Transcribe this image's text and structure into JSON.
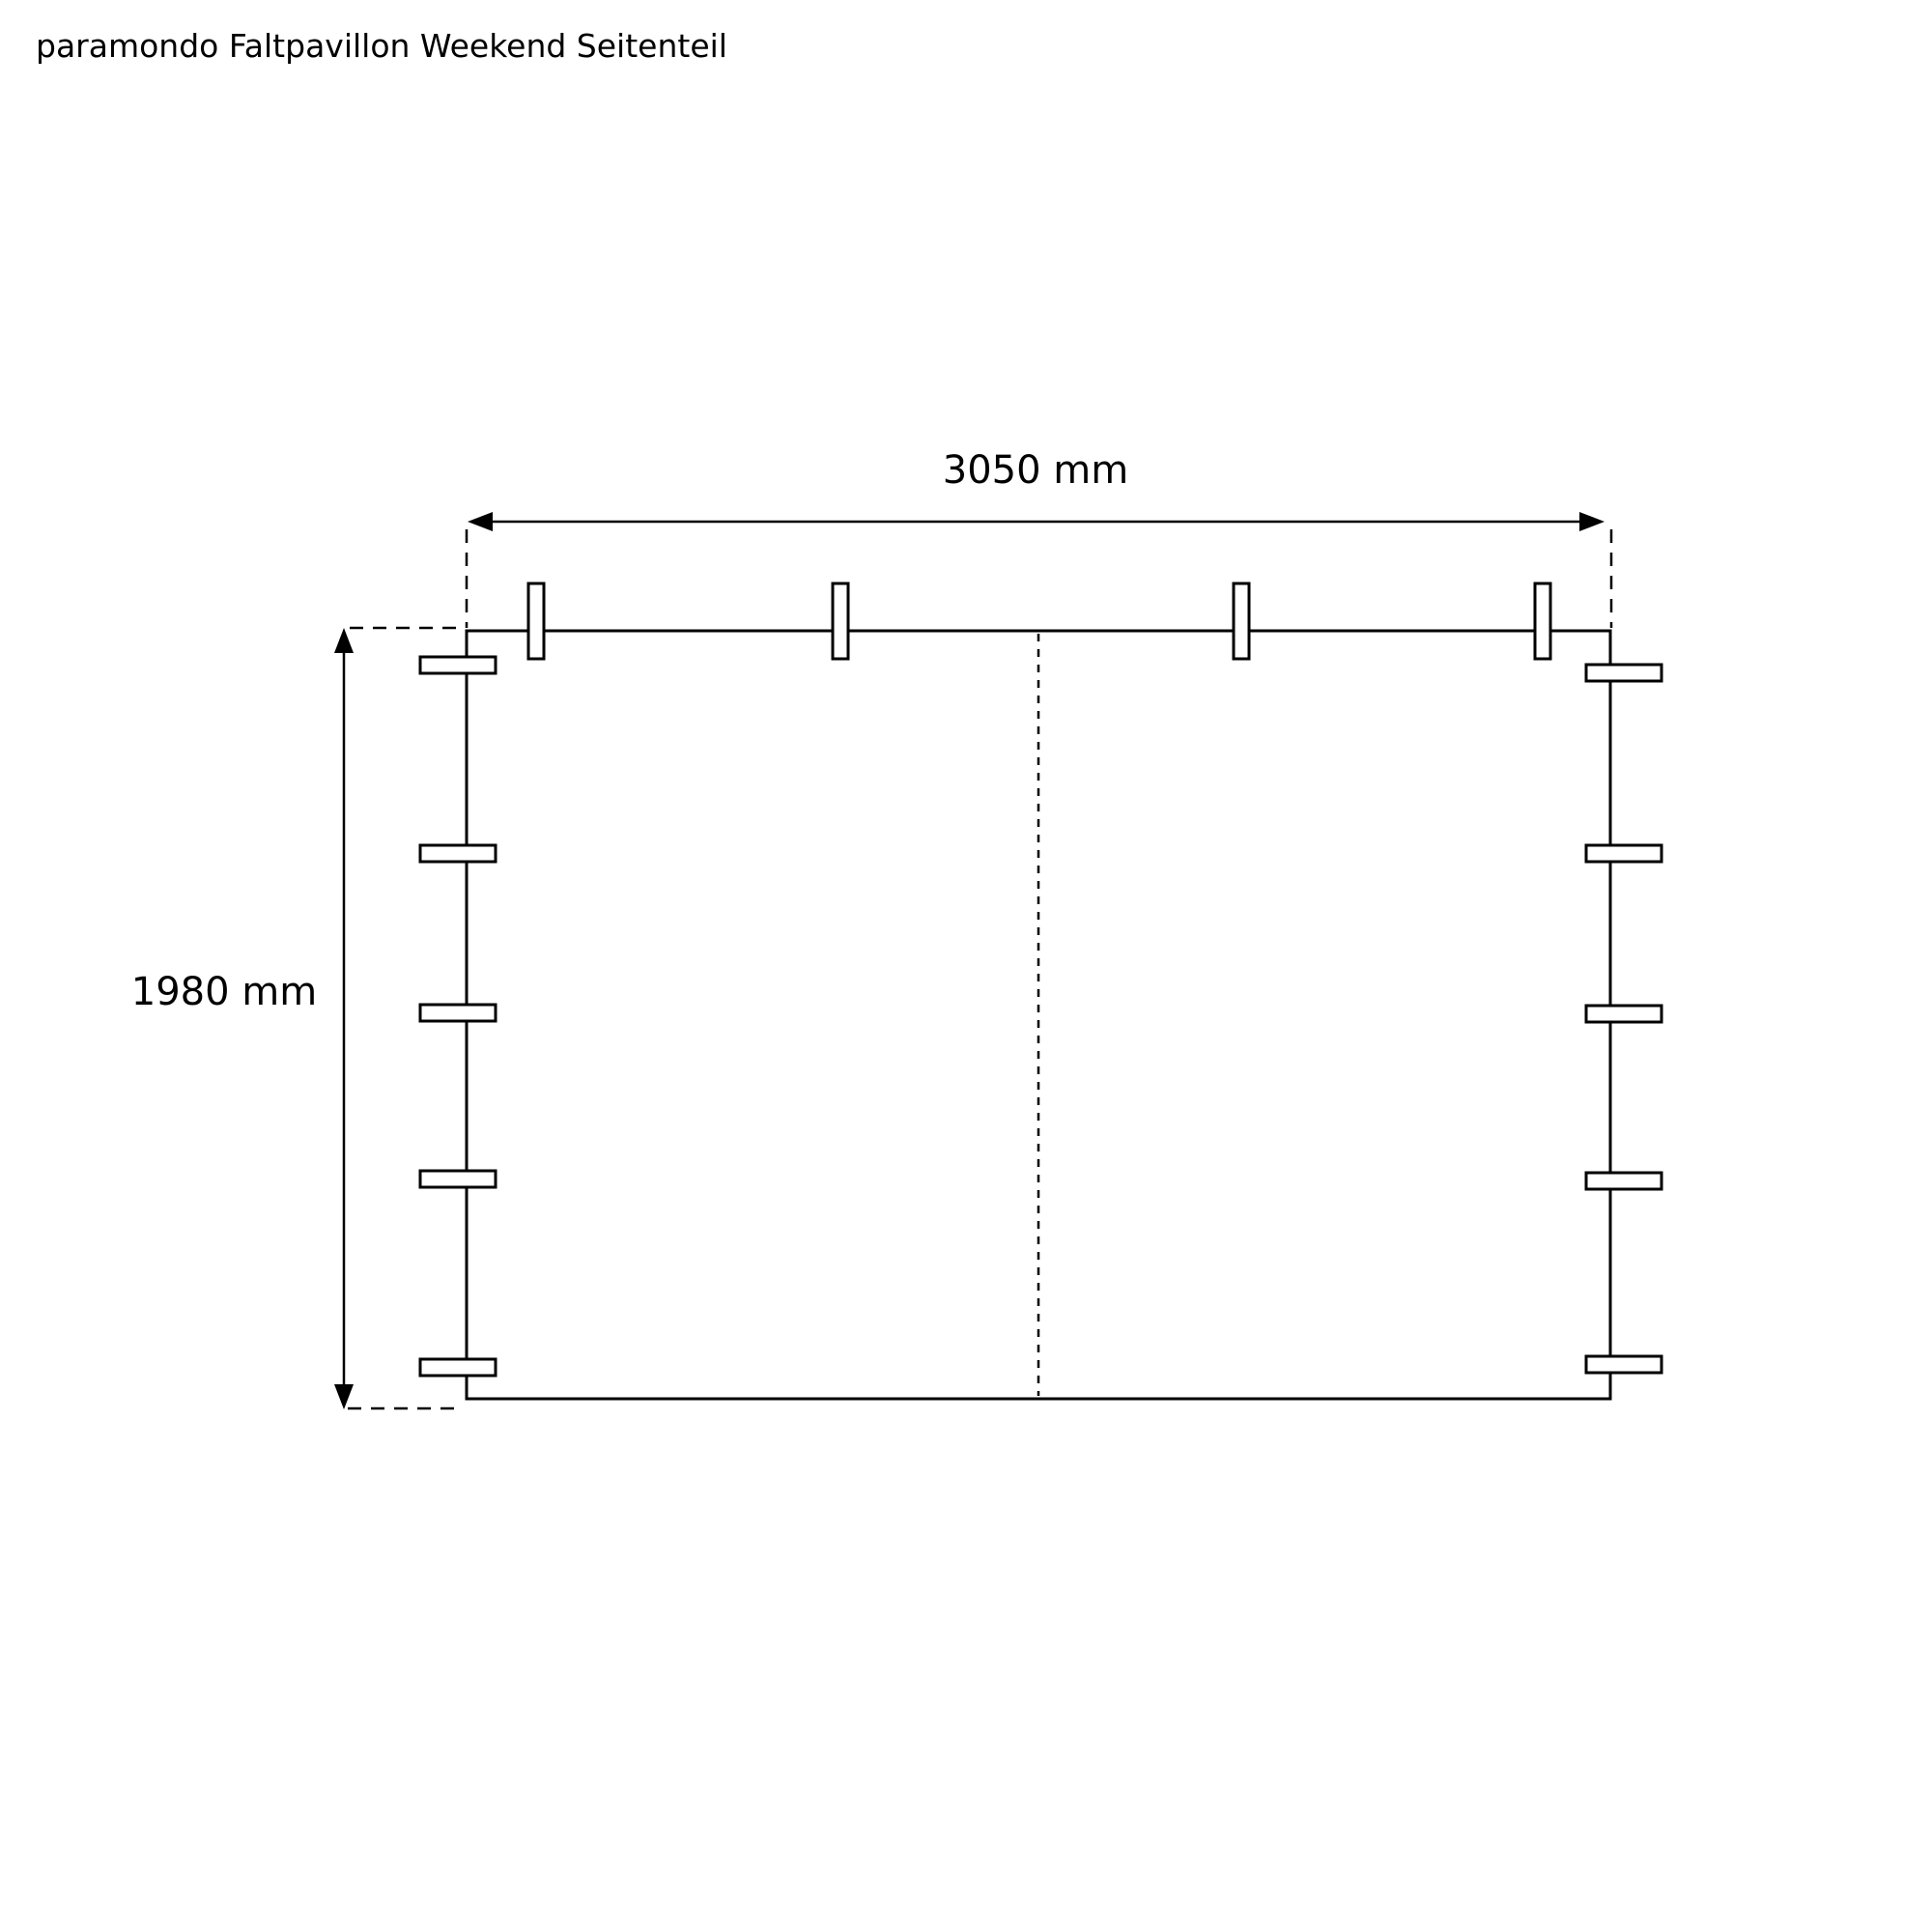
{
  "page": {
    "title": "paramondo Faltpavillon Weekend Seitenteil",
    "background_color": "#ffffff",
    "line_color": "#000000"
  },
  "diagram": {
    "type": "technical-drawing",
    "subject": "pavilion side panel front view",
    "width_dimension": {
      "label": "3050 mm"
    },
    "height_dimension": {
      "label": "1980 mm"
    },
    "features": {
      "top_straps_count": 4,
      "left_straps_count": 5,
      "right_straps_count": 5,
      "center_fold_line": "dashed"
    }
  }
}
